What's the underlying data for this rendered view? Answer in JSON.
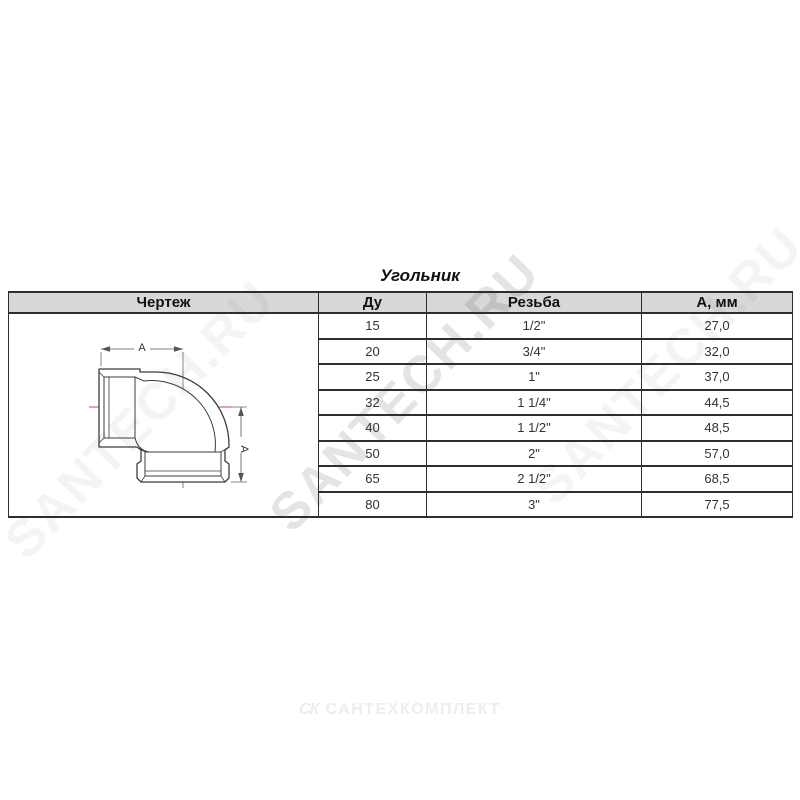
{
  "page": {
    "title": "Угольник",
    "background": "#ffffff"
  },
  "watermark": {
    "text": "SANTECH.RU",
    "color": "#2d2d2d",
    "main_opacity": 0.13,
    "side_opacity": 0.05
  },
  "footer": {
    "logo_mark": "СК",
    "logo_text": "САНТЕХКОМПЛЕКТ",
    "color": "#ededed"
  },
  "table": {
    "columns": [
      "Чертеж",
      "Ду",
      "Резьба",
      "А, мм"
    ],
    "header_bg": "#d8d8d8",
    "border_color": "#2e2e2e",
    "rows": [
      {
        "du": "15",
        "thread": "1/2\"",
        "a_mm": "27,0"
      },
      {
        "du": "20",
        "thread": "3/4\"",
        "a_mm": "32,0"
      },
      {
        "du": "25",
        "thread": "1\"",
        "a_mm": "37,0"
      },
      {
        "du": "32",
        "thread": "1 1/4\"",
        "a_mm": "44,5"
      },
      {
        "du": "40",
        "thread": "1 1/2\"",
        "a_mm": "48,5"
      },
      {
        "du": "50",
        "thread": "2\"",
        "a_mm": "57,0"
      },
      {
        "du": "65",
        "thread": "2 1/2\"",
        "a_mm": "68,5"
      },
      {
        "du": "80",
        "thread": "3\"",
        "a_mm": "77,5"
      }
    ]
  },
  "drawing": {
    "dim_label_top": "A",
    "dim_label_right": "A",
    "centerline_color": "#cc4b4b",
    "line_color": "#3c3c3c"
  }
}
